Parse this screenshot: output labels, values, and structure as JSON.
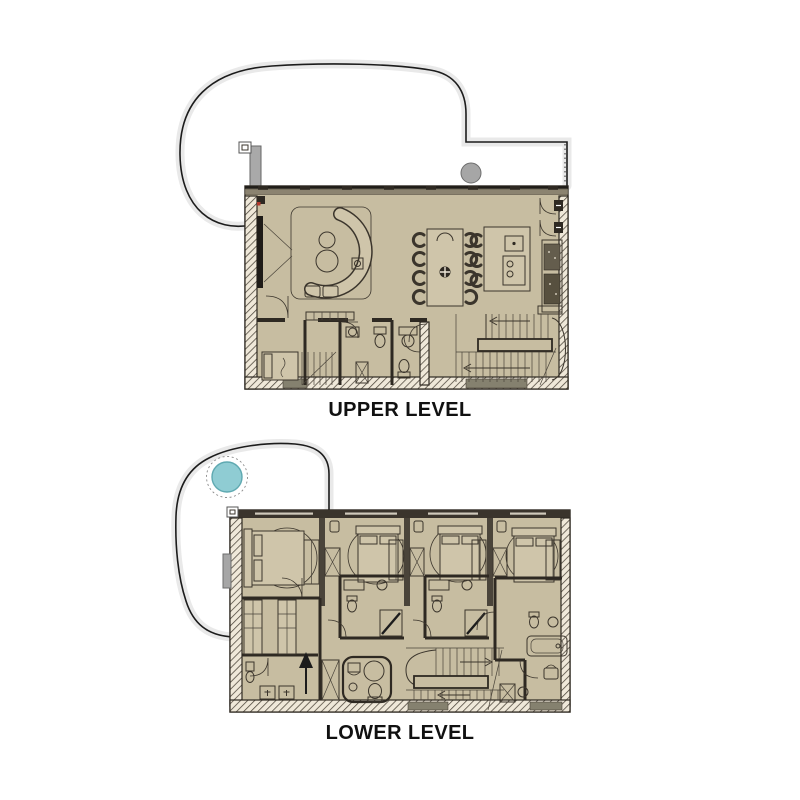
{
  "page": {
    "background": "#ffffff",
    "type": "two-level floor plan diagram"
  },
  "colors": {
    "floor_tan": "#c7bda1",
    "furniture_fill": "#cfc5aa",
    "wall_dark": "#2e2922",
    "line": "#3b352c",
    "terrace_halo": "#e9e9e9",
    "terrace_outline": "#1c1c1c",
    "column_gray": "#a6a6a6",
    "hot_tub_teal": "#8fccd3",
    "bottom_insert": "#85816f",
    "label_text": "#111111"
  },
  "upper_plan": {
    "label": "UPPER LEVEL",
    "features": [
      "terrace-outline",
      "terrace-column",
      "living-sofa",
      "rug",
      "fireplace",
      "dining-table",
      "dining-chairs-8",
      "kitchen-island",
      "island-stools-3",
      "kitchen-appliances",
      "balcony-doors",
      "u-stairs",
      "entry-daybed",
      "bathroom-1",
      "bathroom-2",
      "bench"
    ]
  },
  "lower_plan": {
    "label": "LOWER LEVEL",
    "features": [
      "terrace-outline",
      "hot-tub",
      "bedroom-1-bed",
      "bedroom-2-bed",
      "bedroom-3-bed",
      "bedroom-4-bed",
      "rug-circles",
      "wardrobes",
      "ensuite-bathrooms",
      "bunk-room",
      "laundry",
      "entry-arrow",
      "powder-room",
      "u-stairs",
      "bathtub"
    ]
  }
}
